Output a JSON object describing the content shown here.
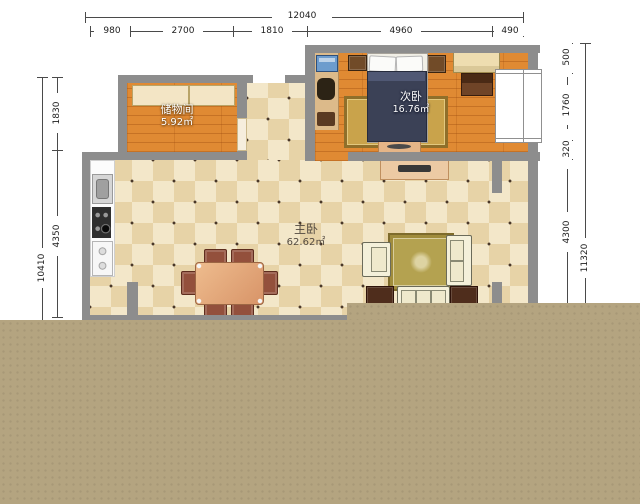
{
  "rooms": [
    {
      "name": "储物间",
      "area": "5.92㎡"
    },
    {
      "name": "次卧",
      "area": "16.76㎡"
    },
    {
      "name": "主卧",
      "area": "62.62㎡"
    }
  ],
  "dimensions": {
    "top_total": "12040",
    "top_segments": [
      "980",
      "2700",
      "1810",
      "4960",
      "490"
    ],
    "left_total": "10410",
    "left_segments": [
      "1830",
      "4350"
    ],
    "right_total": "11320",
    "right_segments": [
      "500",
      "1760",
      "320",
      "4300"
    ]
  },
  "colors": {
    "wall": "#8d8d8d",
    "wood_floor": "#e08a33",
    "tile_light": "#f3e7c9",
    "tile_dark": "#e7d3a7",
    "overlay_tan": "#b4a480",
    "bed": "#3b4156",
    "rug_gold": "#c9a34b"
  }
}
